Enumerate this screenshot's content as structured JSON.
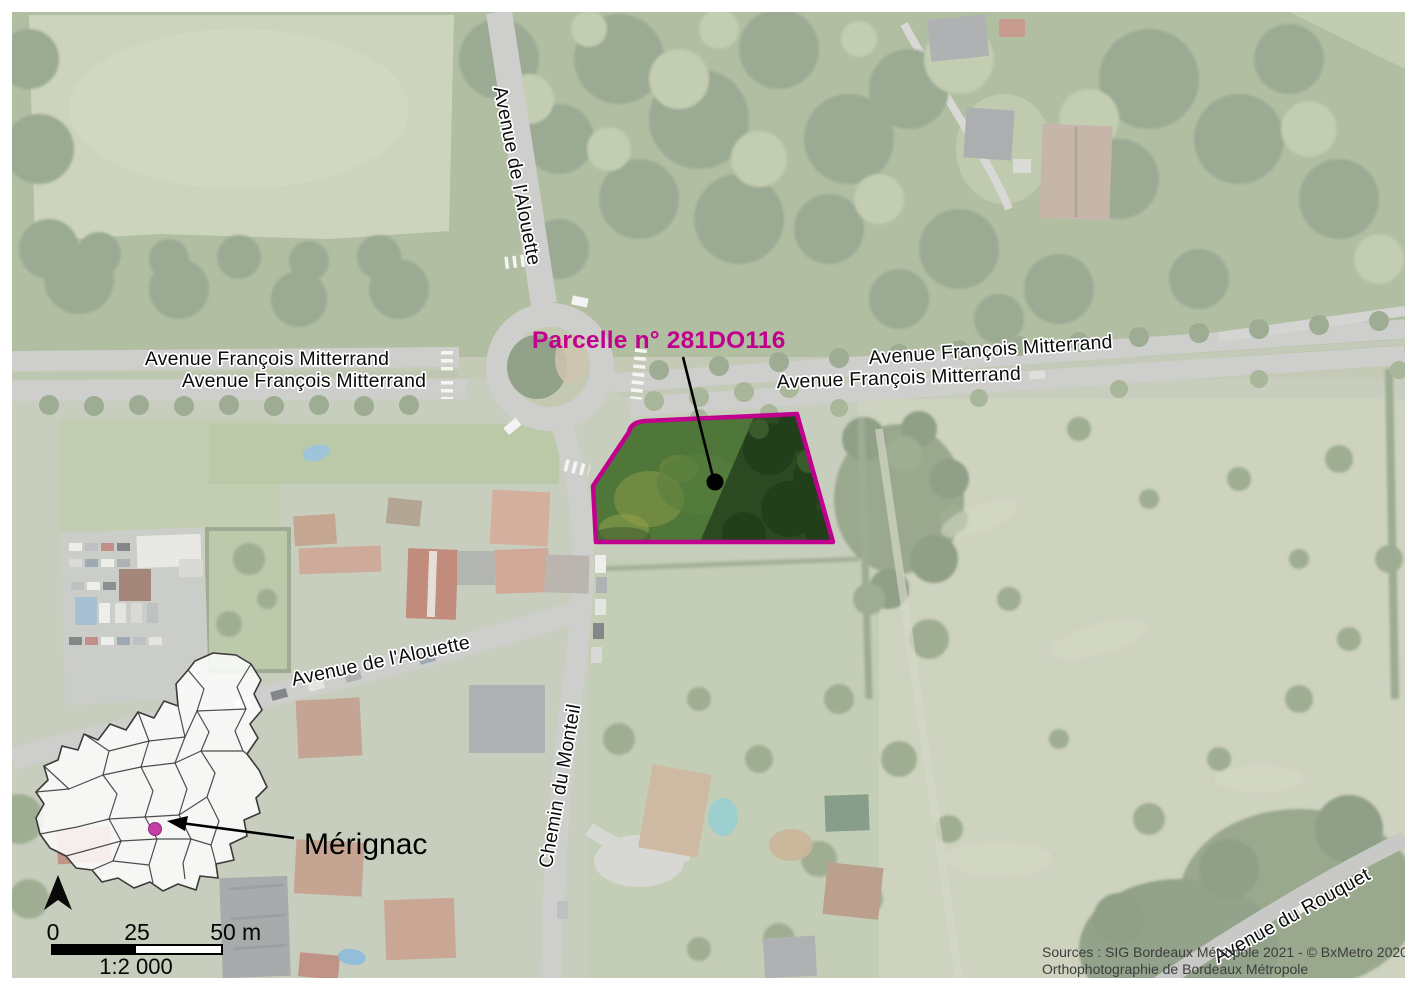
{
  "annotations": {
    "parcel_label": "Parcelle n° 281DO116",
    "commune_label": "Mérignac"
  },
  "street_labels": {
    "alouette_top": "Avenue de l'Alouette",
    "mitterrand_left_upper": "Avenue François Mitterrand",
    "mitterrand_left_lower": "Avenue François Mitterrand",
    "mitterrand_right_upper": "Avenue François Mitterrand",
    "mitterrand_right_lower": "Avenue François Mitterrand",
    "alouette_southwest": "Avenue de l'Alouette",
    "monteil": "Chemin du Monteil",
    "rouquet": "Avenue du Rouquet"
  },
  "scale_bar": {
    "tick_start": "0",
    "tick_mid": "25",
    "tick_end": "50",
    "unit": "m",
    "ratio": "1:2 000"
  },
  "credits": {
    "line1": "Sources : SIG Bordeaux Métropole 2021 - © BxMetro 2020,",
    "line2": "Orthophotographie de Bordeaux Métropole"
  },
  "colors": {
    "parcel_outline": "#C2008E",
    "parcel_label": "#C2008E",
    "inset_dot": "#C43FA5",
    "leader_line": "#000000"
  },
  "icons": {
    "north_arrow": "north-arrow-triangle"
  }
}
